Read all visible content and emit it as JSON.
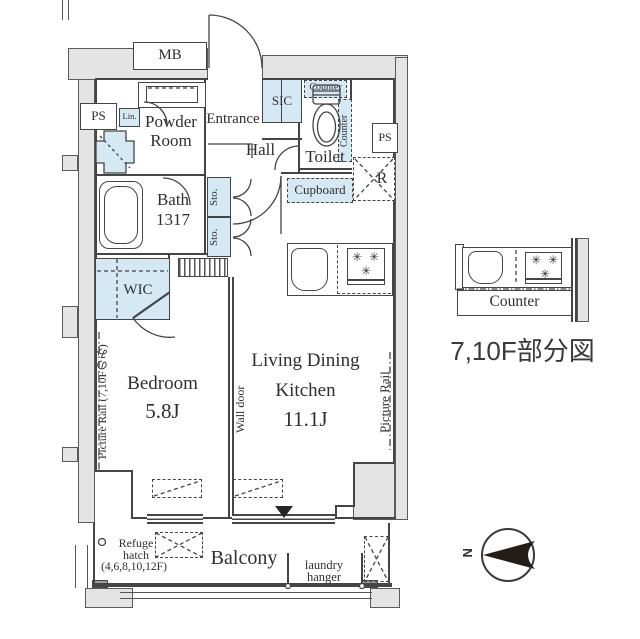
{
  "colors": {
    "accent_blue": "#d5e9f5",
    "wall_gray": "#e4e4e4",
    "line": "#454545"
  },
  "floorplan": {
    "meter_box": "MB",
    "pipe_space_left": "PS",
    "pipe_space_right": "PS",
    "linen": "Lin.",
    "washer": "W",
    "powder_room_line1": "Powder",
    "powder_room_line2": "Room",
    "entrance": "Entrance",
    "shoe_closet": "SIC",
    "counter_toilet_top": "Counter",
    "counter_toilet_side": "Counter",
    "toilet": "Toilet",
    "hall": "Hall",
    "cupboard": "Cupboard",
    "refrigerator": "R",
    "bath_line1": "Bath",
    "bath_line2": "1317",
    "storage_upper": "Sto.",
    "storage_lower": "Sto.",
    "walk_in_closet": "WIC",
    "bedroom": "Bedroom",
    "bedroom_size": "5.8J",
    "wall_door": "Wall door",
    "ldk_line1": "Living Dining",
    "ldk_line2": "Kitchen",
    "ldk_size": "11.1J",
    "picture_rail_left": "Picture Rail (7,10Fのみ)",
    "picture_rail_right": "Picture Rail",
    "balcony": "Balcony",
    "laundry_hanger_line1": "laundry",
    "laundry_hanger_line2": "hanger",
    "refuge_line1": "Refuge",
    "refuge_line2": "hatch",
    "refuge_line3": "(4,6,8,10,12F)"
  },
  "side_view": {
    "counter": "Counter",
    "title": "7,10F部分図"
  },
  "compass": {
    "north": "N"
  }
}
